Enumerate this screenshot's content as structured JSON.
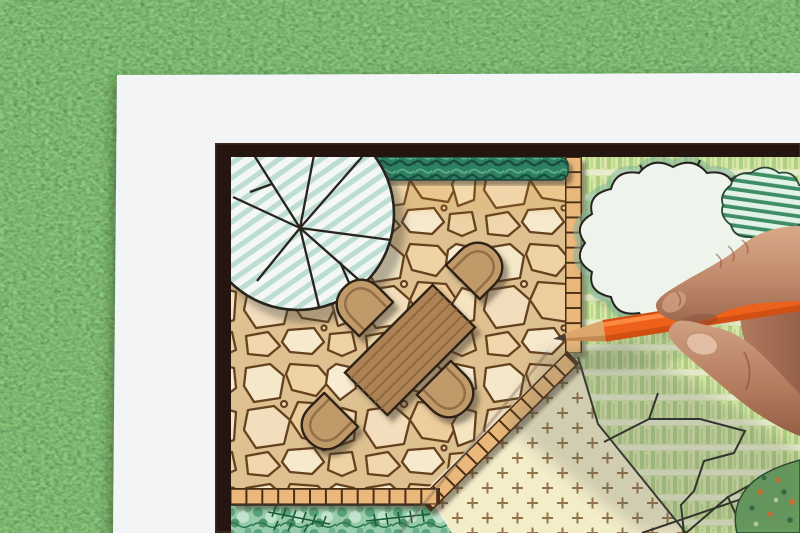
{
  "scene": {
    "kind": "photograph",
    "description": "Top-down photo of a hand holding an orange colored pencil over a hand-drawn garden landscape plan on white paper lying on green grass",
    "objects": {
      "background": "artificial grass lawn",
      "sheet": "white paper sheet",
      "plan_frame": "dark drawn border of the landscape plan",
      "patio": "flagstone patio with wooden dining table and four chairs",
      "round_tree": "round tree canopy symbol with branch lines and teal stripes",
      "scalloped_tree": "large scalloped tree canopy symbol with radial branches",
      "hatched_shrub": "scalloped shrub symbol with green stripes",
      "hedge": "dark green hedge strip",
      "tile_paths": "tiled edge bands around the patio",
      "lawn": "striped green lawn area",
      "groundcover": "pale yellow groundcover area with cross marks",
      "planting_bed": "green planting bed with conifer sprigs",
      "flower_bed": "colorful flower bed in bottom right corner",
      "hand": "right hand gripping a pencil",
      "pencil": "orange colored pencil pointing at the plan"
    }
  },
  "colors": {
    "grass_base": "#4c763c",
    "paper": "#f3f4f6",
    "frame": "#241510",
    "stone_grout": "#dec190",
    "stone_outline": "#66411f",
    "tile": "#e9b87a",
    "hedge": "#2e8062",
    "tree_stripe": "#b7dbd1",
    "lawn": "#d8e6ab",
    "groundcover": "#f4edca",
    "bed_green": "#98cba9",
    "table": "#ad8254",
    "chair": "#c19a6a",
    "pencil": "#ee611a",
    "pencil_wood": "#dca76b",
    "skin": "#b27a5e"
  }
}
